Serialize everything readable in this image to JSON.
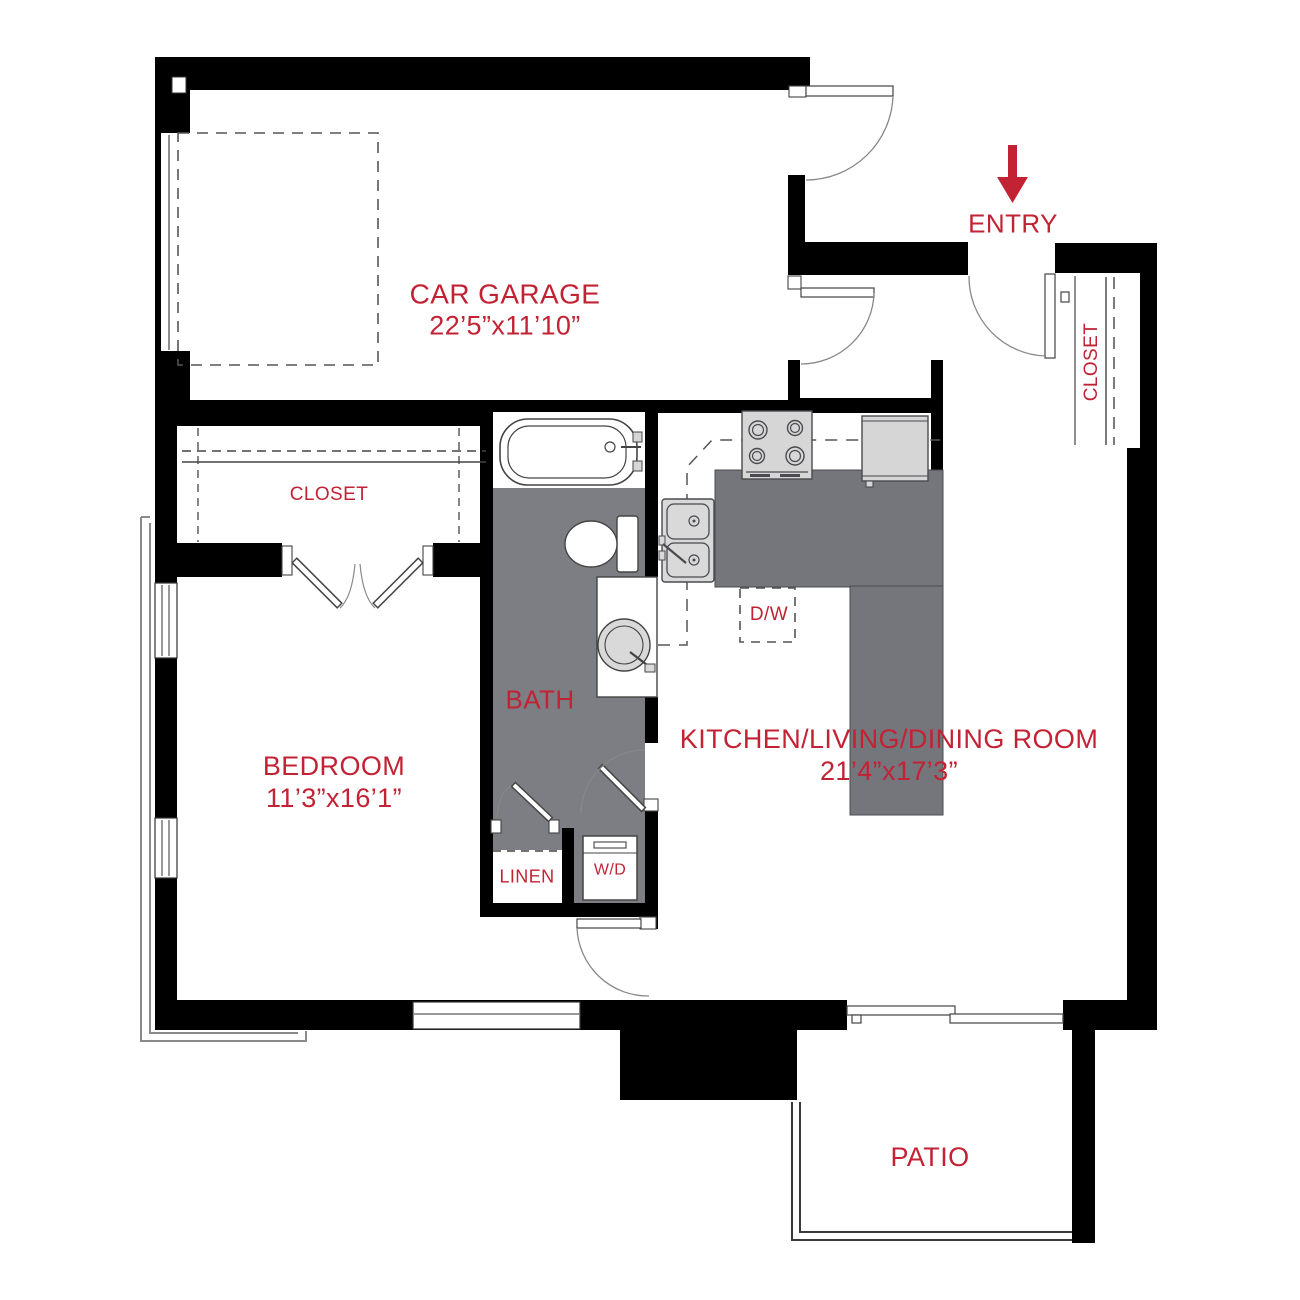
{
  "plan_title_visible": false,
  "colors": {
    "label_red": "#c22233",
    "wall_black": "#000000",
    "bath_floor_gray": "#7d7d84",
    "counter_gray": "#75757c",
    "appliance_gray": "#d6d6d6",
    "outline_gray": "#8a8a8a"
  },
  "rooms": {
    "garage": {
      "name": "CAR GARAGE",
      "dims": "22’5”x11’10”"
    },
    "entry": {
      "name": "ENTRY"
    },
    "entry_closet": {
      "name": "CLOSET"
    },
    "bedroom_closet": {
      "name": "CLOSET"
    },
    "bedroom": {
      "name": "BEDROOM",
      "dims": "11’3”x16’1”"
    },
    "bath": {
      "name": "BATH"
    },
    "kitchen_living_dining": {
      "name": "KITCHEN/LIVING/DINING ROOM",
      "dims": "21’4”x17’3”"
    },
    "linen": {
      "name": "LINEN"
    },
    "washer_dryer": {
      "name": "W/D"
    },
    "dishwasher": {
      "name": "D/W"
    },
    "patio": {
      "name": "PATIO"
    }
  }
}
